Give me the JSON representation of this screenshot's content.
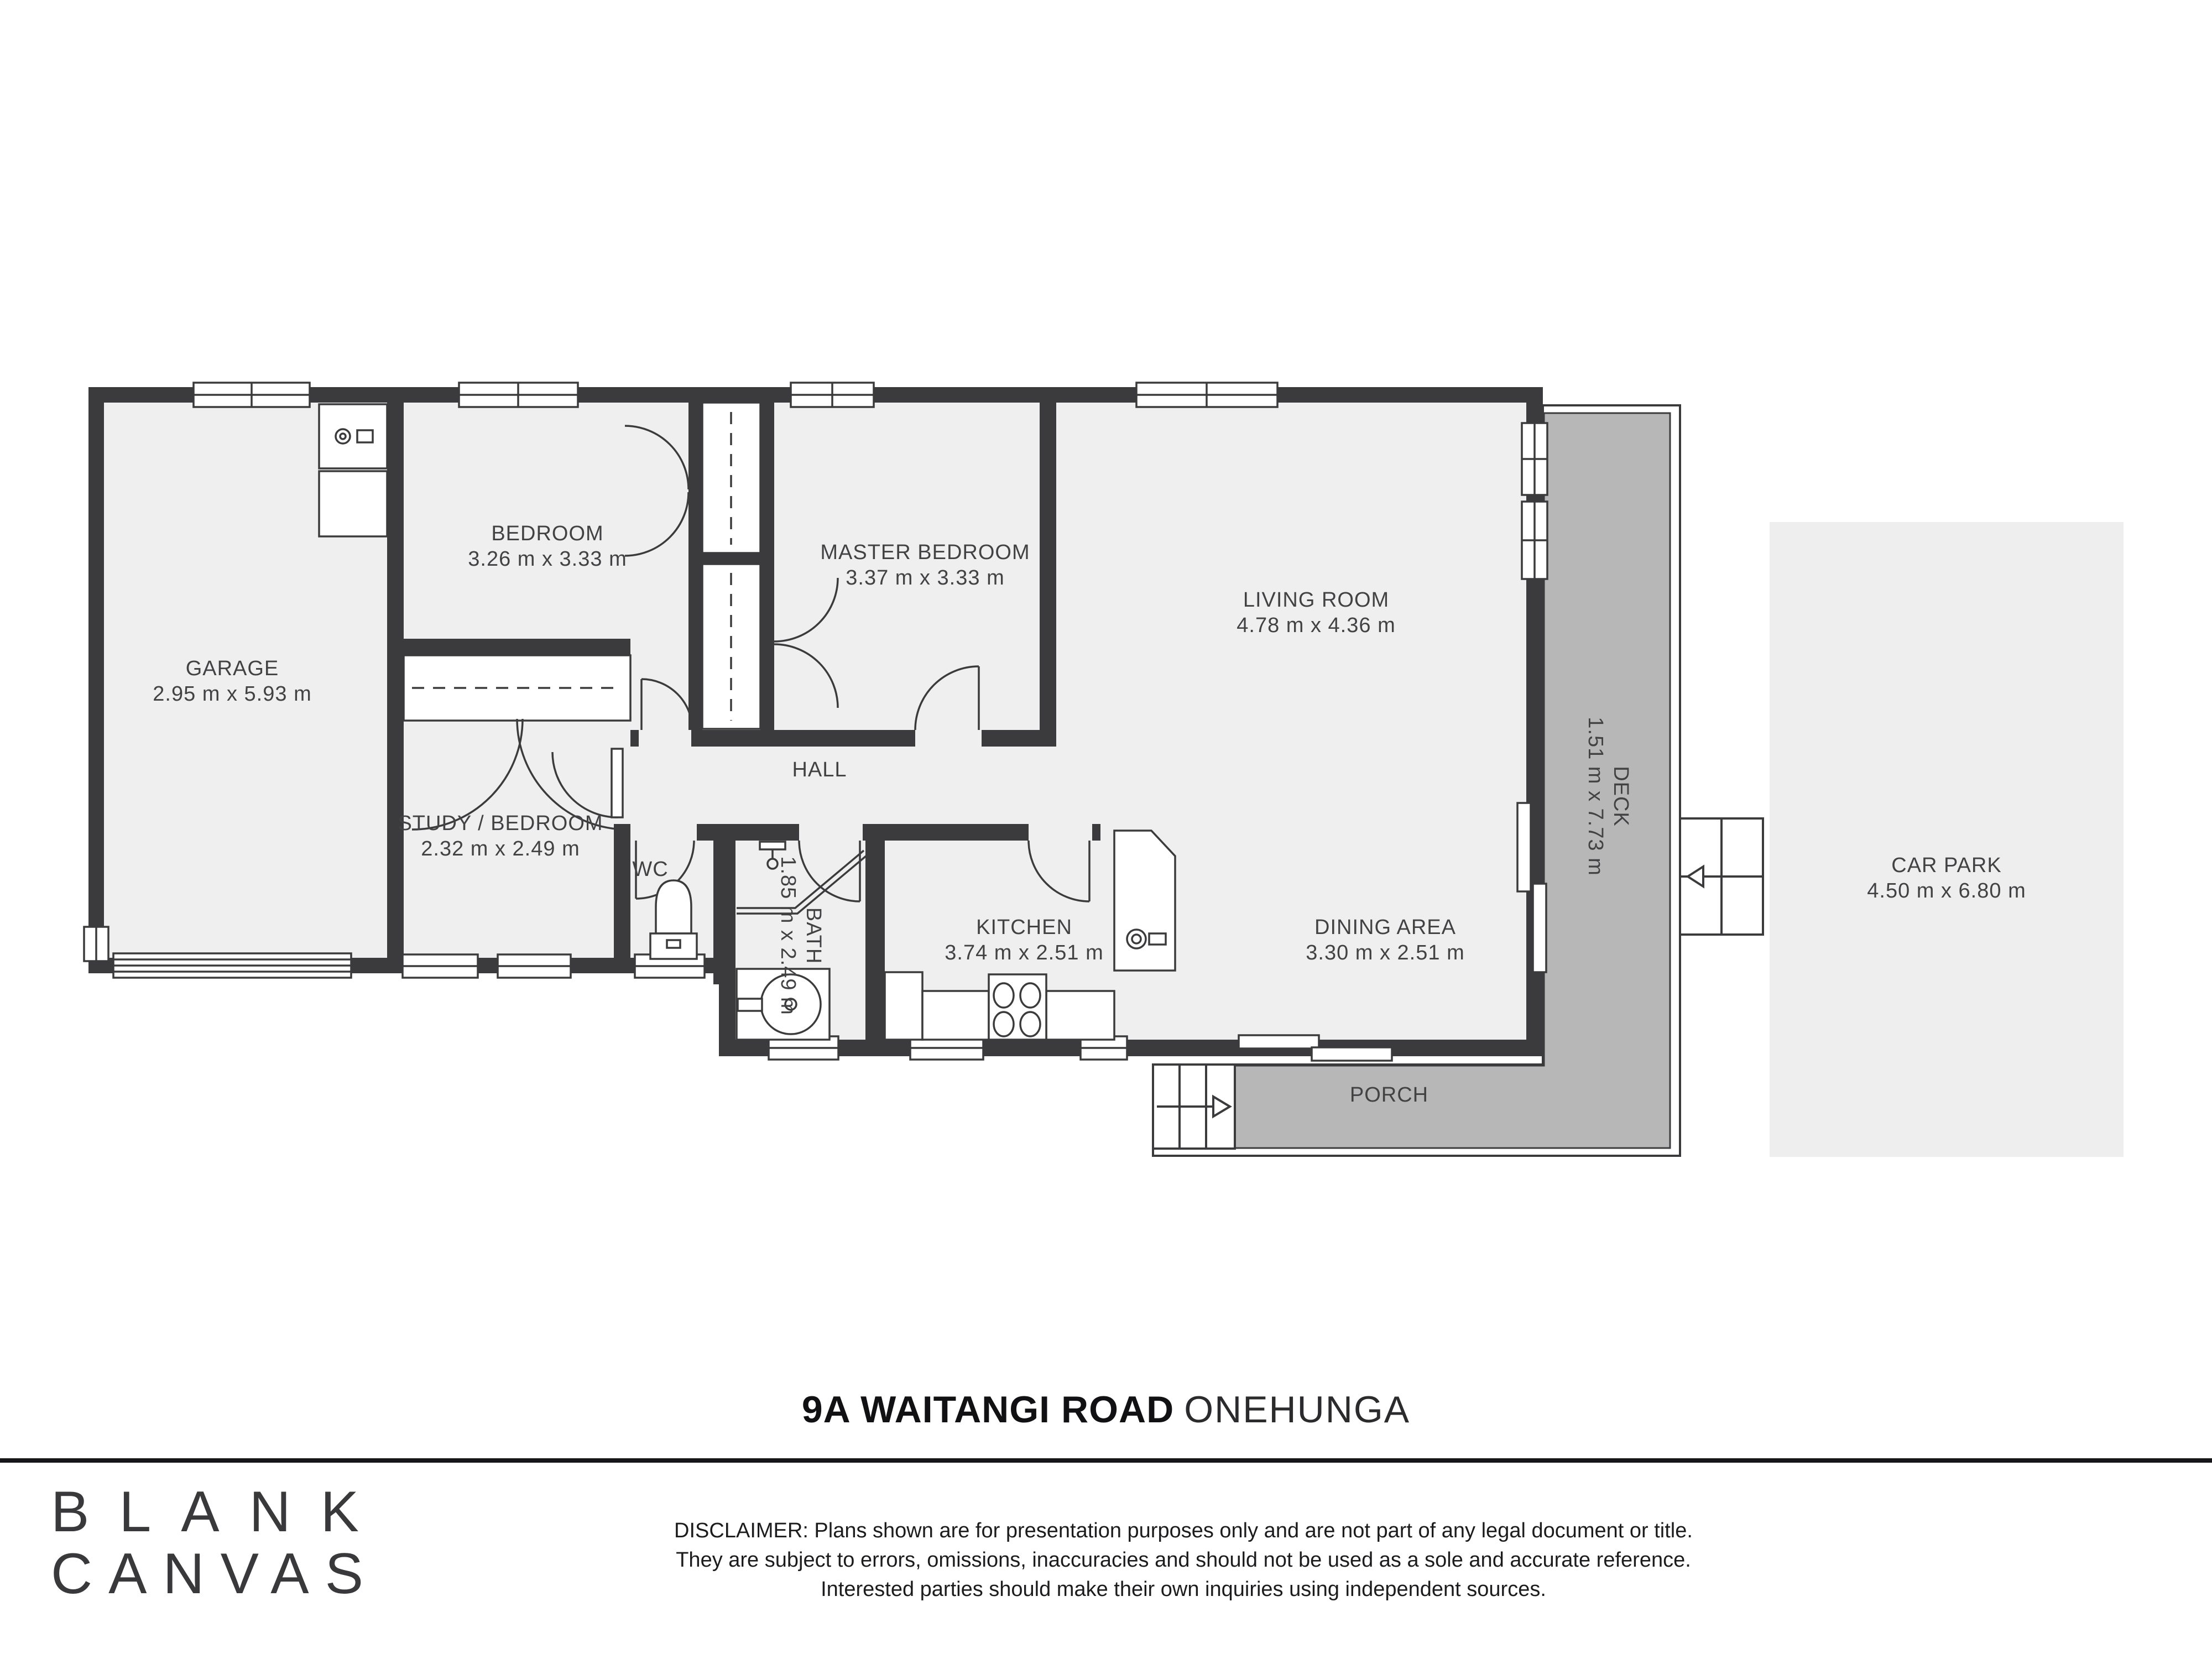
{
  "title": {
    "address": "9A WAITANGI ROAD",
    "suburb": "ONEHUNGA"
  },
  "logo": {
    "line1": "BLANK",
    "line2": "CANVAS"
  },
  "disclaimer": {
    "line1": "DISCLAIMER: Plans shown are for presentation purposes only and are not part of any legal document or title.",
    "line2": "They are subject to errors, omissions, inaccuracies and should not be used as a sole and accurate reference.",
    "line3": "Interested parties should make their own inquiries using independent sources."
  },
  "rooms": {
    "garage": {
      "name": "GARAGE",
      "dims": "2.95 m x 5.93 m"
    },
    "bedroom": {
      "name": "BEDROOM",
      "dims": "3.26 m x 3.33 m"
    },
    "master_bedroom": {
      "name": "MASTER BEDROOM",
      "dims": "3.37 m x 3.33 m"
    },
    "living_room": {
      "name": "LIVING ROOM",
      "dims": "4.78 m x 4.36 m"
    },
    "hall": {
      "name": "HALL"
    },
    "study_bedroom": {
      "name": "STUDY / BEDROOM",
      "dims": "2.32 m x 2.49 m"
    },
    "wc": {
      "name": "WC"
    },
    "bath": {
      "name": "BATH",
      "dims": "1.85 m x 2.49 m"
    },
    "kitchen": {
      "name": "KITCHEN",
      "dims": "3.74 m x 2.51 m"
    },
    "dining_area": {
      "name": "DINING AREA",
      "dims": "3.30 m x 2.51 m"
    },
    "porch": {
      "name": "PORCH"
    },
    "deck": {
      "name": "DECK",
      "dims": "1.51 m x 7.73 m"
    },
    "car_park": {
      "name": "CAR PARK",
      "dims": "4.50 m x 6.80 m"
    }
  },
  "colors": {
    "wall": "#3b3a3c",
    "room_fill": "#f0efef",
    "deck_fill": "#b8b7b7",
    "carpark_fill": "#efeeee",
    "line": "#3b3a3c",
    "text": "#424245"
  }
}
